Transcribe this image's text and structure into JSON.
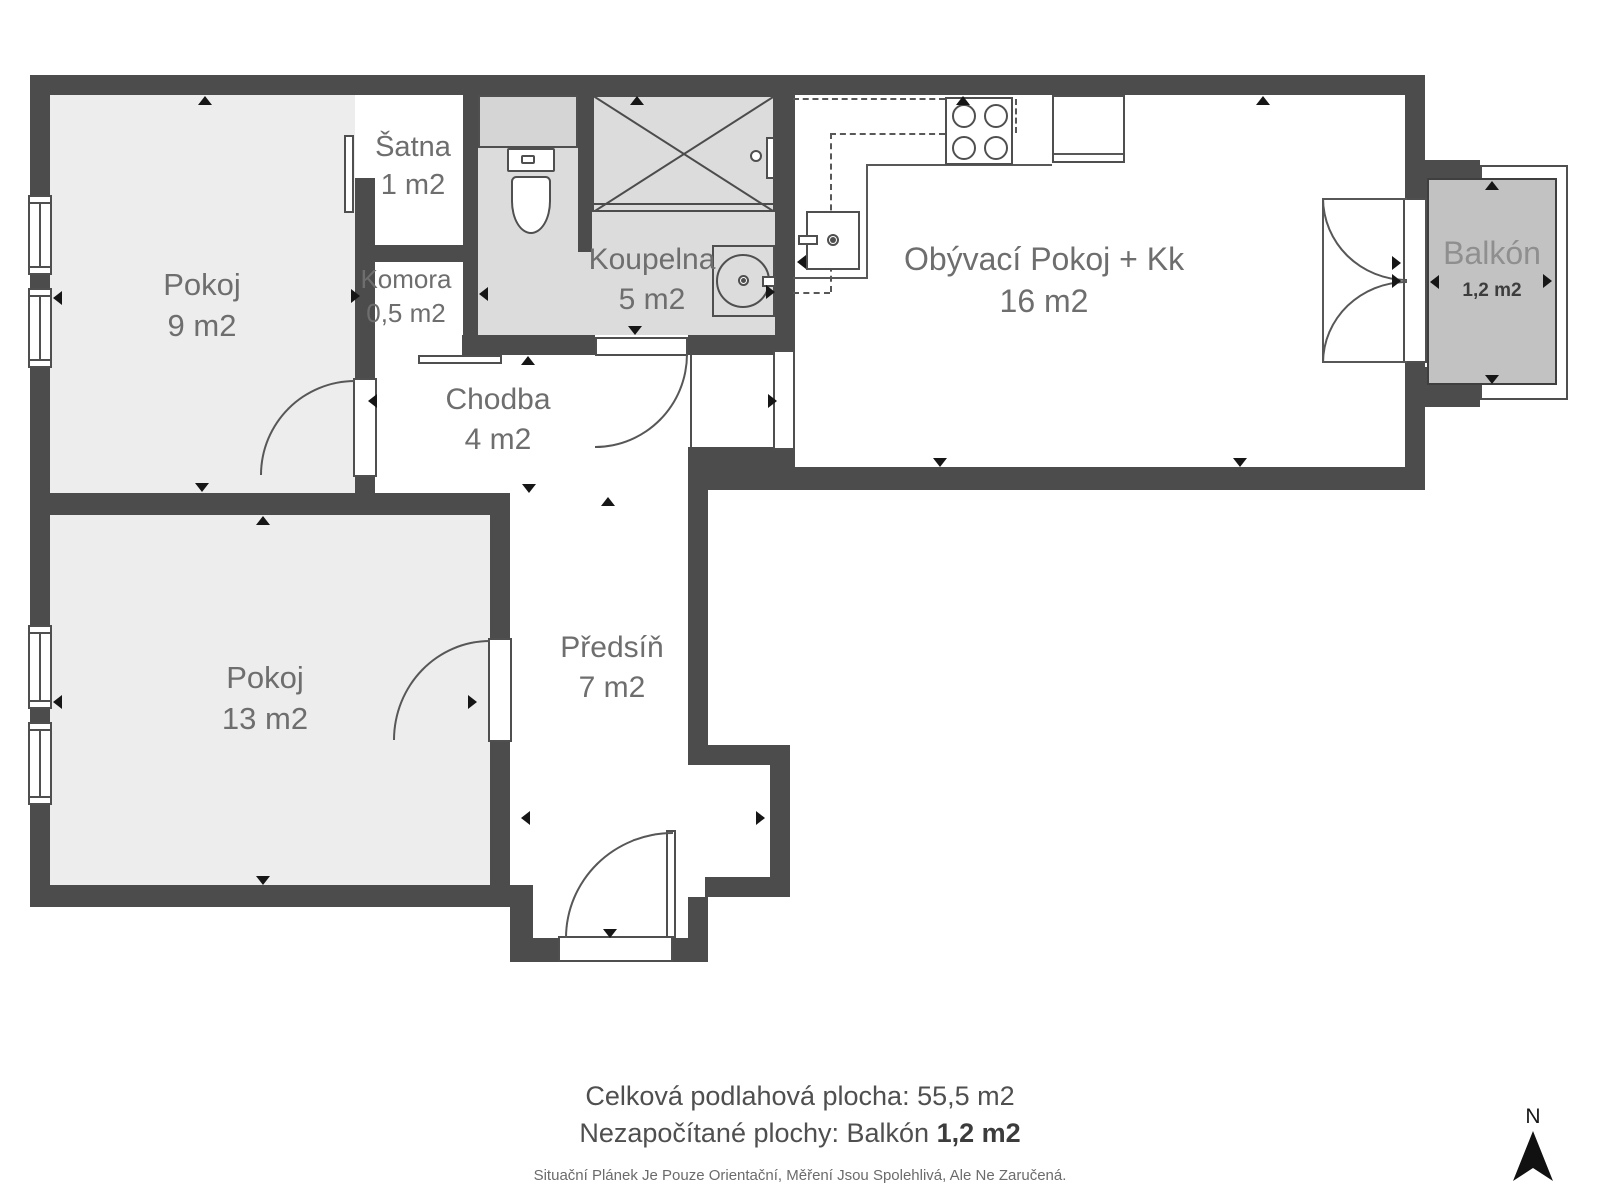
{
  "plan": {
    "rooms": [
      {
        "id": "pokoj9",
        "name": "Pokoj",
        "area": "9 m2"
      },
      {
        "id": "satna",
        "name": "Šatna",
        "area": "1 m2"
      },
      {
        "id": "komora",
        "name": "Komora",
        "area": "0,5 m2"
      },
      {
        "id": "koupelna",
        "name": "Koupelna",
        "area": "5 m2"
      },
      {
        "id": "chodba",
        "name": "Chodba",
        "area": "4 m2"
      },
      {
        "id": "obyvaci",
        "name": "Obývací Pokoj + Kk",
        "area": "16 m2"
      },
      {
        "id": "balkon",
        "name": "Balkón",
        "area": "1,2 m2"
      },
      {
        "id": "pokoj13",
        "name": "Pokoj",
        "area": "13 m2"
      },
      {
        "id": "predsin",
        "name": "Předsíň",
        "area": "7 m2"
      }
    ],
    "colors": {
      "wall": "#4c4c4c",
      "room_fill": "#ededed",
      "bathroom_fill": "#dcdcdc",
      "balcony_fill": "#c2c2c2",
      "label_text": "#6e6e6e"
    }
  },
  "summary": {
    "line1": "Celková podlahová plocha: 55,5 m2",
    "line2_label": "Nezapočítané plochy: Balkón",
    "line2_value": "1,2 m2",
    "disclaimer": "Situační Plánek Je Pouze Orientační, Měření Jsou Spolehlivá, Ale Ne Zaručená."
  },
  "compass": {
    "label": "N"
  }
}
